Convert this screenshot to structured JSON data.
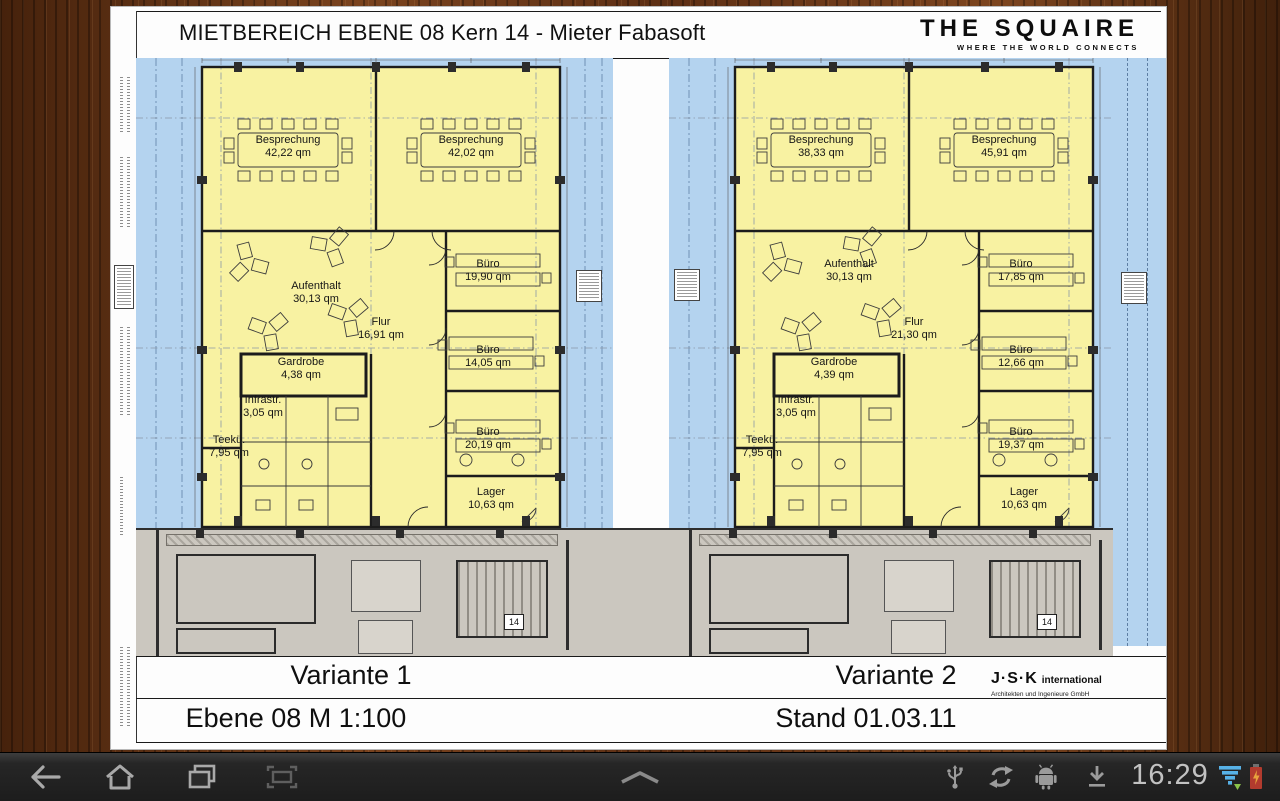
{
  "document": {
    "title": "MIETBEREICH EBENE 08 Kern 14 - Mieter Fabasoft",
    "logo": {
      "name": "THE SQUAIRE",
      "tagline": "WHERE THE WORLD CONNECTS"
    },
    "plans": [
      {
        "variant": "Variante 1",
        "rooms": [
          {
            "name": "Besprechung",
            "area": "42,22 qm"
          },
          {
            "name": "Besprechung",
            "area": "42,02 qm"
          },
          {
            "name": "Aufenthalt",
            "area": "30,13 qm"
          },
          {
            "name": "Büro",
            "area": "19,90 qm"
          },
          {
            "name": "Flur",
            "area": "16,91 qm"
          },
          {
            "name": "Büro",
            "area": "14,05 qm"
          },
          {
            "name": "Gardrobe",
            "area": "4,38 qm"
          },
          {
            "name": "Infrastr.",
            "area": "3,05 qm"
          },
          {
            "name": "Teekü.",
            "area": "7,95 qm"
          },
          {
            "name": "Büro",
            "area": "20,19 qm"
          },
          {
            "name": "Lager",
            "area": "10,63 qm"
          }
        ]
      },
      {
        "variant": "Variante 2",
        "rooms": [
          {
            "name": "Besprechung",
            "area": "38,33 qm"
          },
          {
            "name": "Besprechung",
            "area": "45,91 qm"
          },
          {
            "name": "Aufenthalt",
            "area": "30,13 qm"
          },
          {
            "name": "Büro",
            "area": "17,85 qm"
          },
          {
            "name": "Flur",
            "area": "21,30 qm"
          },
          {
            "name": "Büro",
            "area": "12,66 qm"
          },
          {
            "name": "Gardrobe",
            "area": "4,39 qm"
          },
          {
            "name": "Infrastr.",
            "area": "3,05 qm"
          },
          {
            "name": "Teekü.",
            "area": "7,95 qm"
          },
          {
            "name": "Büro",
            "area": "19,37 qm"
          },
          {
            "name": "Lager",
            "area": "10,63 qm"
          }
        ]
      }
    ],
    "stair_label": "14",
    "footer": {
      "scale_caption": "Ebene 08 M 1:100",
      "date_caption": "Stand 01.03.11",
      "firm": {
        "name": "J·S·K",
        "suffix": "international",
        "subtitle": "Architekten und Ingenieure GmbH"
      }
    }
  },
  "navbar": {
    "clock": "16:29",
    "icons": {
      "back": "back-arrow",
      "home": "home",
      "recents": "recent-apps",
      "screenshot": "screenshot-frame",
      "chevron": "chevron-up",
      "usb": "usb",
      "sync": "sync",
      "adb": "android-debug",
      "download": "download",
      "signal": "signal-strength",
      "battery": "battery-charging"
    }
  },
  "colors": {
    "plan_yellow": "#f8f2a2",
    "plan_blue": "#b4d3ef",
    "core_gray": "#cbc7bf",
    "wood_brown": "#5d2f14",
    "navbar_gray": "#2b2b2b",
    "signal_blue": "#57b1e6",
    "battery_red": "#b23b2e",
    "arrow_green": "#8bc34a"
  }
}
